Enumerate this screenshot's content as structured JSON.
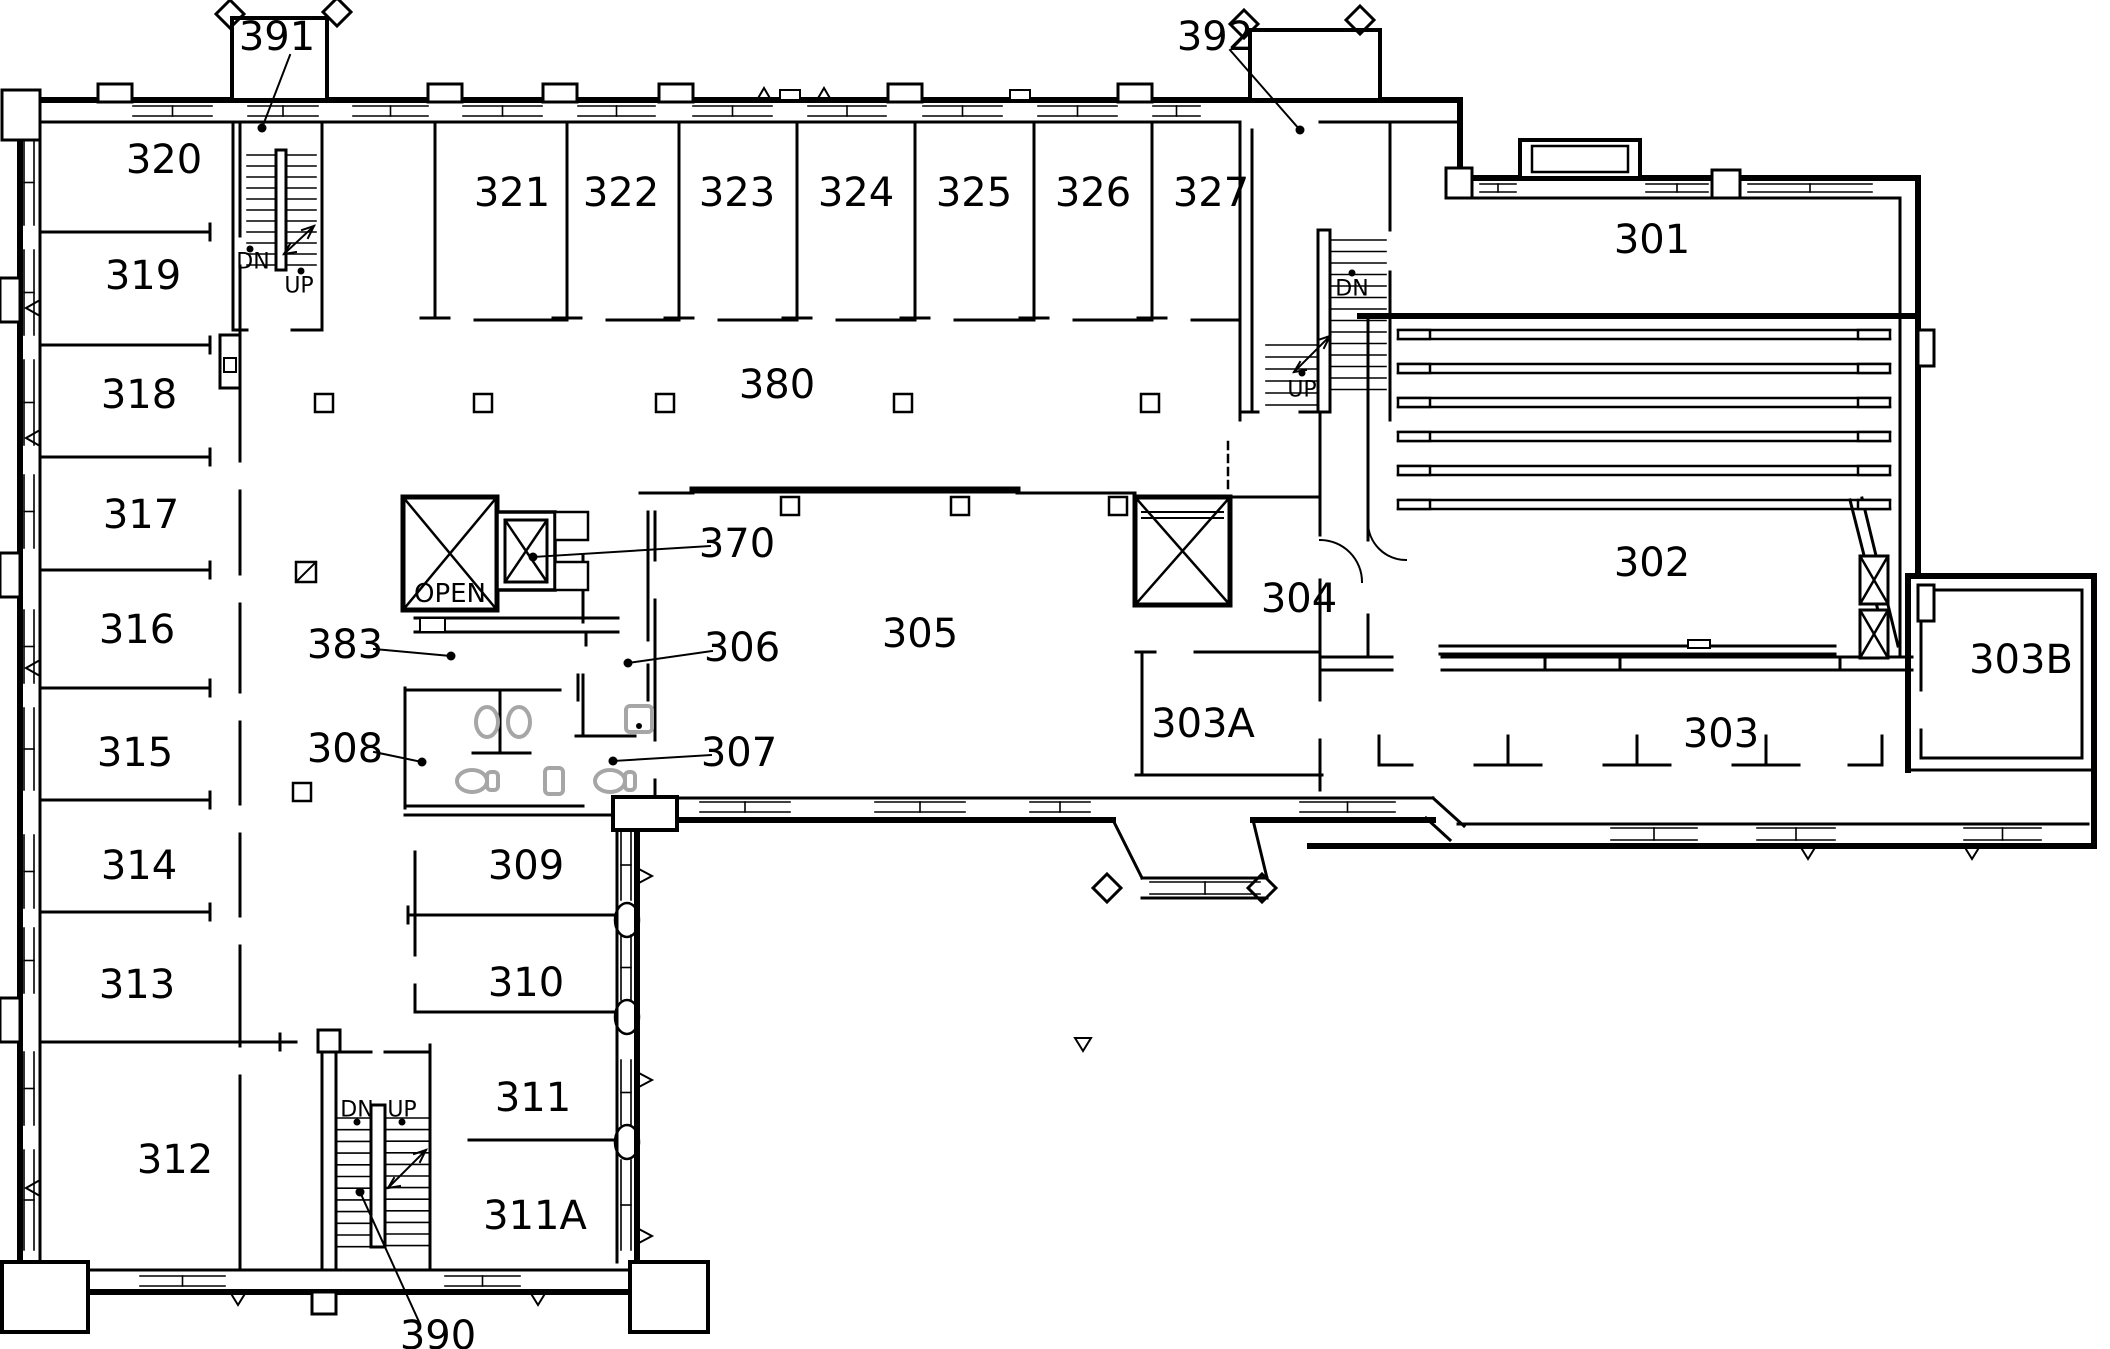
{
  "drawing": {
    "type": "architectural-floor-plan",
    "floor": "third-floor",
    "units": "rooms numbered in the 300 series"
  },
  "colors": {
    "line": "#000000",
    "fixture": "#a6a6a6",
    "background": "#ffffff"
  },
  "room_labels": [
    {
      "id": "301",
      "label": "301",
      "x": 1652,
      "y": 240,
      "size": 40
    },
    {
      "id": "302",
      "label": "302",
      "x": 1652,
      "y": 563,
      "size": 40
    },
    {
      "id": "303",
      "label": "303",
      "x": 1721,
      "y": 734,
      "size": 40
    },
    {
      "id": "303A",
      "label": "303A",
      "x": 1203,
      "y": 724,
      "size": 40
    },
    {
      "id": "303B",
      "label": "303B",
      "x": 2021,
      "y": 660,
      "size": 40
    },
    {
      "id": "304",
      "label": "304",
      "x": 1299,
      "y": 599,
      "size": 40
    },
    {
      "id": "305",
      "label": "305",
      "x": 920,
      "y": 634,
      "size": 40
    },
    {
      "id": "306",
      "label": "306",
      "x": 742,
      "y": 648,
      "size": 40
    },
    {
      "id": "307",
      "label": "307",
      "x": 739,
      "y": 753,
      "size": 40
    },
    {
      "id": "308",
      "label": "308",
      "x": 345,
      "y": 749,
      "size": 40
    },
    {
      "id": "309",
      "label": "309",
      "x": 526,
      "y": 866,
      "size": 40
    },
    {
      "id": "310",
      "label": "310",
      "x": 526,
      "y": 983,
      "size": 40
    },
    {
      "id": "311",
      "label": "311",
      "x": 533,
      "y": 1098,
      "size": 40
    },
    {
      "id": "311A",
      "label": "311A",
      "x": 535,
      "y": 1216,
      "size": 40
    },
    {
      "id": "312",
      "label": "312",
      "x": 175,
      "y": 1160,
      "size": 40
    },
    {
      "id": "313",
      "label": "313",
      "x": 137,
      "y": 985,
      "size": 40
    },
    {
      "id": "314",
      "label": "314",
      "x": 139,
      "y": 866,
      "size": 40
    },
    {
      "id": "315",
      "label": "315",
      "x": 135,
      "y": 753,
      "size": 40
    },
    {
      "id": "316",
      "label": "316",
      "x": 137,
      "y": 630,
      "size": 40
    },
    {
      "id": "317",
      "label": "317",
      "x": 141,
      "y": 515,
      "size": 40
    },
    {
      "id": "318",
      "label": "318",
      "x": 139,
      "y": 395,
      "size": 40
    },
    {
      "id": "319",
      "label": "319",
      "x": 143,
      "y": 276,
      "size": 40
    },
    {
      "id": "320",
      "label": "320",
      "x": 164,
      "y": 160,
      "size": 40
    },
    {
      "id": "321",
      "label": "321",
      "x": 512,
      "y": 193,
      "size": 40
    },
    {
      "id": "322",
      "label": "322",
      "x": 621,
      "y": 193,
      "size": 40
    },
    {
      "id": "323",
      "label": "323",
      "x": 737,
      "y": 193,
      "size": 40
    },
    {
      "id": "324",
      "label": "324",
      "x": 856,
      "y": 193,
      "size": 40
    },
    {
      "id": "325",
      "label": "325",
      "x": 974,
      "y": 193,
      "size": 40
    },
    {
      "id": "326",
      "label": "326",
      "x": 1093,
      "y": 193,
      "size": 40
    },
    {
      "id": "327",
      "label": "327",
      "x": 1211,
      "y": 193,
      "size": 40
    },
    {
      "id": "370",
      "label": "370",
      "x": 737,
      "y": 544,
      "size": 40
    },
    {
      "id": "380",
      "label": "380",
      "x": 777,
      "y": 385,
      "size": 40
    },
    {
      "id": "383",
      "label": "383",
      "x": 345,
      "y": 645,
      "size": 40
    },
    {
      "id": "390",
      "label": "390",
      "x": 438,
      "y": 1336,
      "size": 40
    },
    {
      "id": "391",
      "label": "391",
      "x": 277,
      "y": 37,
      "size": 40
    },
    {
      "id": "392",
      "label": "392",
      "x": 1215,
      "y": 37,
      "size": 40
    }
  ],
  "stair_direction_labels": [
    {
      "id": "stair-391-dn",
      "label": "DN",
      "x": 253,
      "y": 262,
      "size": 22
    },
    {
      "id": "stair-391-up",
      "label": "UP",
      "x": 299,
      "y": 286,
      "size": 22
    },
    {
      "id": "stair-392-dn",
      "label": "DN",
      "x": 1352,
      "y": 289,
      "size": 22
    },
    {
      "id": "stair-392-up",
      "label": "UP",
      "x": 1302,
      "y": 390,
      "size": 22
    },
    {
      "id": "stair-390-dn",
      "label": "DN",
      "x": 357,
      "y": 1110,
      "size": 22
    },
    {
      "id": "stair-390-up",
      "label": "UP",
      "x": 402,
      "y": 1110,
      "size": 22
    }
  ],
  "shaft_labels": [
    {
      "id": "open-shaft",
      "label": "OPEN",
      "x": 450,
      "y": 594,
      "size": 26
    }
  ],
  "leaders": [
    {
      "for": "391",
      "x1": 290,
      "y1": 55,
      "x2": 262,
      "y2": 128
    },
    {
      "for": "392",
      "x1": 1230,
      "y1": 50,
      "x2": 1300,
      "y2": 130
    },
    {
      "for": "370",
      "x1": 710,
      "y1": 546,
      "x2": 533,
      "y2": 557
    },
    {
      "for": "383",
      "x1": 374,
      "y1": 649,
      "x2": 451,
      "y2": 656
    },
    {
      "for": "306",
      "x1": 712,
      "y1": 651,
      "x2": 628,
      "y2": 663
    },
    {
      "for": "307",
      "x1": 711,
      "y1": 755,
      "x2": 613,
      "y2": 761
    },
    {
      "for": "308",
      "x1": 374,
      "y1": 752,
      "x2": 422,
      "y2": 762
    },
    {
      "for": "390",
      "x1": 420,
      "y1": 1324,
      "x2": 360,
      "y2": 1192
    }
  ],
  "direction_dots": [
    [
      250,
      249
    ],
    [
      301,
      271
    ],
    [
      1352,
      273
    ],
    [
      1302,
      373
    ],
    [
      357,
      1122
    ],
    [
      402,
      1122
    ]
  ]
}
